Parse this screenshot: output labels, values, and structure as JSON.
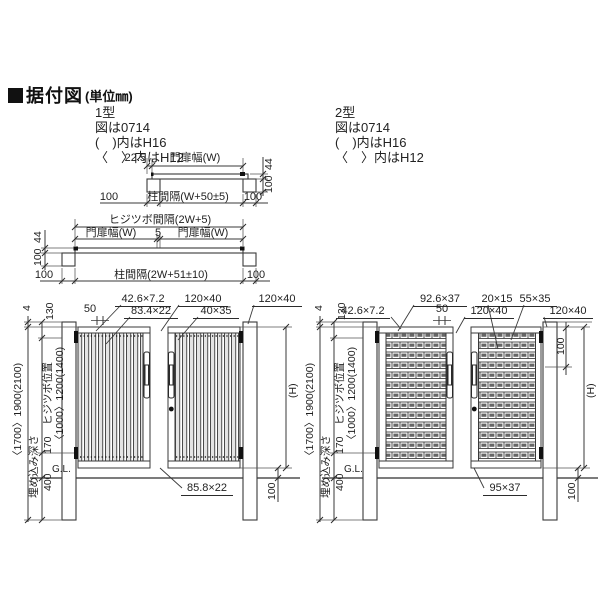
{
  "header": {
    "title": "据付図",
    "unit": "(単位㎜)"
  },
  "type1": {
    "name": "1型",
    "note1": "図は0714",
    "note2": "(　)内はH16",
    "note3": "〈　〉内はH12"
  },
  "type2": {
    "name": "2型",
    "note1": "図は0714",
    "note2": "(　)内はH16",
    "note3": "〈　〉内はH12"
  },
  "plan_single": {
    "offset": "22.5",
    "leaf_width": "門扉幅(W)",
    "depth_top": "44",
    "depth_post": "100",
    "left": "100",
    "span": "柱間隔(W+50±5)",
    "right": "100"
  },
  "plan_double": {
    "hinge_span": "ヒジツボ間隔(2W+5)",
    "leaf_width_left": "門扉幅(W)",
    "gap": "5",
    "leaf_width_right": "門扉幅(W)",
    "depth_top": "44",
    "depth_post": "100",
    "left": "100",
    "span": "柱間隔(2W+51±10)",
    "right": "100"
  },
  "elev1": {
    "co_top1": "42.6×7.2",
    "co_top2": "120×40",
    "co_top3": "120×40",
    "co_mid1": "83.4×22",
    "co_mid2": "40×35",
    "dim50": "50",
    "co_bottom": "85.8×22",
    "dim4": "4",
    "total": "〈1700〉1900(2100)",
    "dim130": "130",
    "hinge_label": "ヒジツボ位置",
    "hinge_values": "〈1000〉1200(1400)",
    "dim170": "170",
    "embed": "埋め込み深さ",
    "dim400": "400",
    "gl": "G.L.",
    "height": "(H)",
    "clearance": "100"
  },
  "elev2": {
    "co_top1": "92.6×37",
    "co_top2": "20×15",
    "co_top3": "55×35",
    "co_mid1": "42.6×7.2",
    "dim50": "50",
    "co_mid3": "120×40",
    "co_mid4": "120×40",
    "co_bottom": "95×37",
    "dim4": "4",
    "total": "〈1700〉1900(2100)",
    "dim130": "130",
    "hinge_label": "ヒジツボ位置",
    "hinge_values": "〈1000〉1200(1400)",
    "dim170": "170",
    "embed": "埋め込み深さ",
    "dim400": "400",
    "gl": "G.L.",
    "height": "(H)",
    "top100": "100",
    "clearance": "100"
  },
  "colors": {
    "line": "#3a3a3a",
    "text": "#1f1f1f"
  }
}
